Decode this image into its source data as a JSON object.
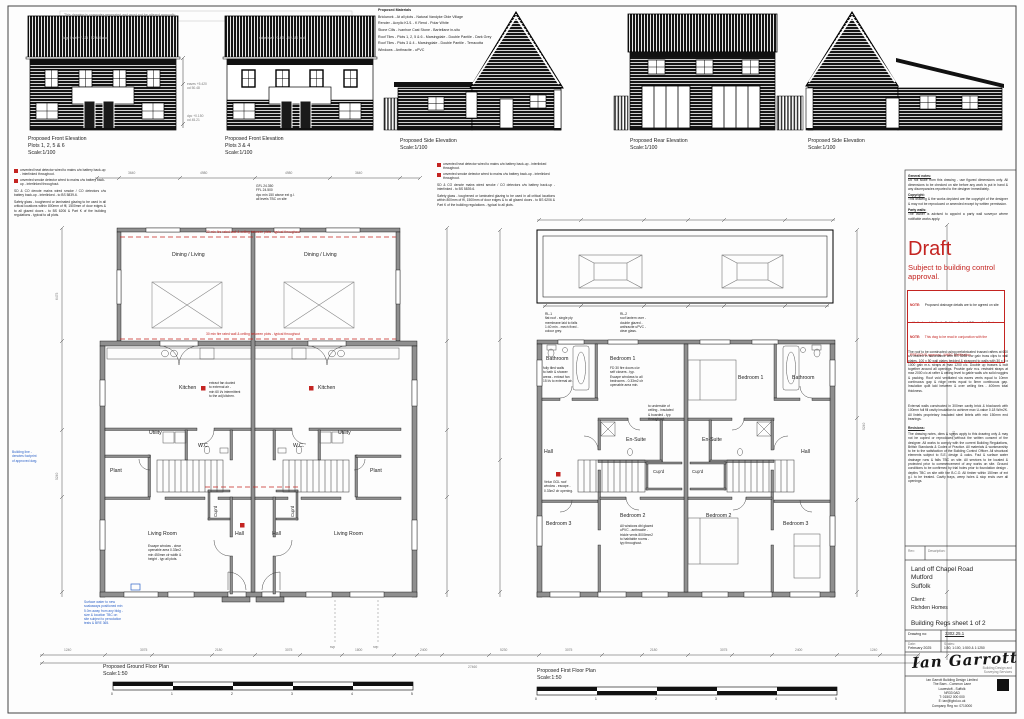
{
  "page": {
    "top_note": "This drawing is computer generated and must not be altered manually"
  },
  "materials": {
    "title": "Proposed Materials",
    "items": [
      "Brickwork - At all plots - Natural Vandyke Olde Village",
      "Render - Acrylic K1/1 - K Rend - Polar White",
      "Stone Cills - Ivanhoe Cast Stone - Bartellane in-situ",
      "Roof Tiles - Plots 1, 2, 5 & 6 - Marsingdale - Double Pantile - Dark Grey",
      "Roof Tiles - Plots 3 & 4 - Marsingdale - Double Pantile - Terracotta",
      "Windows - Anthracite - uPVC"
    ]
  },
  "elevations": [
    {
      "title": "Proposed Front Elevation",
      "plots": "Plots 1, 2, 5 & 6",
      "scale": "Scale:1/100"
    },
    {
      "title": "Proposed Front Elevation",
      "plots": "Plots 3 & 4",
      "scale": "Scale:1/100"
    },
    {
      "title": "Proposed Side Elevation",
      "plots": "",
      "scale": "Scale:1/100"
    },
    {
      "title": "Proposed Rear Elevation",
      "plots": "",
      "scale": "Scale:1/100"
    },
    {
      "title": "Proposed Side Elevation",
      "plots": "",
      "scale": "Scale:1/100"
    }
  ],
  "elev_annots": {
    "ridge1": "ridge level +7.425 - 52.480 aod",
    "ridge2": "ridge level +7.425 - 52.480 aod",
    "eaves": "eaves +5.420\nod 50.48",
    "dpc": "dpc +0.150\nod 45.21"
  },
  "legend": {
    "item_heat": "unvented heat detector wired to mains c/w battery back-up - interlinked throughout.",
    "item_smoke": "unvented smoke detector wired to mains c/w battery back-up - interlinked throughout.",
    "note_sd": "SD & CO denote mains wired smoke / CO detectors c/w battery back-up - interlinked - to BS 5839-6.",
    "note_glass": "Safety glass - toughened or laminated glazing to be used in all critical locations within 800mm of ffl, 1500mm of door edges & to all glazed doors - to BS 6206 & Part K of the building regulations - typical to all plots."
  },
  "ground": {
    "title": "Proposed Ground Floor Plan",
    "scale": "Scale:1:50",
    "rooms": {
      "dining": "Dining / Living",
      "kitchen": "Kitchen",
      "utility": "Utility",
      "wc": "W.C.",
      "plant": "Plant",
      "hall": "Hall",
      "cupd": "Cup'd",
      "living": "Living Room"
    },
    "notes": {
      "levels": "GFL 24.350\nFFL 24.500\ndpc min 150 above ext g.l.\nall levels TBC on site",
      "fire1": "30 min fire rated wall & ceiling between plots - typical throughout",
      "fire2": "30 min fire rated wall & ceiling between plots - typical throughout",
      "kitchen": "extract fan ducted\nto external air -\nmin 60 l/s intermittent\nto the adj kitchen.",
      "living": "Escape window - clear\nopenable area 0.33m2 -\nmin 450mm clr width &\nheight - typ all plots.",
      "svp": "svp",
      "rwp": "rwp",
      "blue_main": "Surface water to new\nsoakaways positioned min\n5.0m away from any bldg -\nsize & location TBC on\nsite subject to percolation\ntests & BRE 365.",
      "blue_side": "Building line -\ndenotes footprint\nof approved dwg."
    }
  },
  "first": {
    "title": "Proposed First Floor Plan",
    "scale": "Scale:1:50",
    "rooms": {
      "bathroom": "Bathroom",
      "bedroom1": "Bedroom 1",
      "ensuite": "En-Suite",
      "hall": "Hall",
      "cupd": "Cup'd",
      "bedroom2": "Bedroom 2",
      "bedroom3": "Bedroom 3"
    },
    "notes": {
      "roof1": "RL-1\nflat roof - single ply\nmembrane laid to falls\n1:40 min - mech fixed -\ncolour grey.",
      "roof2": "RL-2\nroof lantern over -\ndouble glazed -\nanthracite uPVC -\nclear glass.",
      "bath": "fully tiled walls\nto bath & shower\nareas - extract fan\n15 l/s to external air.",
      "bed1": "FD 30 fire doors c/w\nself closers - typ.\nEscape windows to all\nbedrooms - 0.33m2 clr\nopenable area min.",
      "bed1r": "to underside of\nceiling - insulated\n& boarded - typ\nthroughout.",
      "bed2": "All windows dbl glazed\nuPVC - anthracite -\ntrickle vents 8000mm2\nto habitable rooms -\ntyp throughout.",
      "escape": "Velux GGL roof\nwindow - escape -\n0.33m2 clr opening."
    }
  },
  "scalebar": {
    "n0": "0",
    "n1": "1",
    "n2": "2",
    "n3": "3",
    "n4": "4",
    "n5": "5"
  },
  "dims": {
    "t1": "3640",
    "t2": "4980",
    "t3": "4980",
    "t4": "3640",
    "b1": "1240",
    "b2": "3075",
    "b3": "2180",
    "b4": "3075",
    "b5": "1800",
    "b6": "2400",
    "b7": "5230",
    "b8": "3075",
    "b9": "2180",
    "b10": "3075",
    "b11": "2400",
    "b12": "1240",
    "overall": "27460",
    "v1": "6475",
    "v2": "5240",
    "v3": "9240",
    "v4": "12240"
  },
  "right": {
    "h1": "General notes:",
    "p1": "Do not scale from this drawing - use figured dimensions only. All dimensions to be checked on site before any work is put in hand & any discrepancies reported to the designer immediately.",
    "h2": "Copyright:",
    "p2": "This drawing & the works depicted are the copyright of the designer & may not be reproduced or amended except by written permission.",
    "h3": "Party walls:",
    "p3b": "The owner is advised to appoint a party wall surveyor where notifiable works apply.",
    "draft": "Draft",
    "draft_sub": "Subject to building control approval.",
    "note_label1": "NOTE:",
    "note1": "Proposed drainage details are to be agreed on site with the Local Authority Building Control Officer - foul & storm to be confirmed on site.",
    "note_label2": "NOTE:",
    "note2": "This dwg to be read in conjunction with the PREVIOUS approval - NHBC certification.",
    "p4": "The roof to be constructed using prefabricated trussed rafters at 600 c/c braced in accordance with BS 5268 c/w galv truss clips to wall plates. 100 x 50 wall plates bedded & strapped to walls with 30 x 5 x 1000 galv m.s. straps at max 1200 c/c. Double up trusses & bolt together around all openings. Provide galv m.s. restraint straps at max 2000 c/c at rafter & ceiling level to gable walls c/w solid noggins & packing. Roof void ventilated via eaves vents equal to 10mm continuous gap & ridge vents equal to 5mm continuous gap. Insulation quilt laid between & over ceiling ties - 400mm total thickness.",
    "p5": "External walls constructed in 300mm cavity brick & blockwork with 100mm full fill cavity insulation to achieve max U-value 0.18 W/m2K. All lintels proprietary insulated steel lintels with min 150mm end bearings.",
    "rev_h": "Revisions:",
    "p6": "The drawing notes, dims & specs apply to this drawing only & may not be copied or reproduced without the written consent of the designer. All works to comply with the current Building Regulations, British Standards & Codes of Practice. All materials & workmanship to be to the satisfaction of the Building Control Officer. All structural elements subject to S.E. design & calcs. Foul & surface water drainage runs & falls TBC on site. All services to be located & protected prior to commencement of any works on site. Ground conditions to be confirmed by trial holes prior to foundation design - depths TBC on site with the B.C.O. All timber within 150mm of ext g.l. to be treated. Cavity trays, weep holes & stop ends over all openings.",
    "rev_cell1": "Rev:",
    "rev_cell2": "Description:",
    "address": "Land off Chapel Road\nMutford\nSuffolk",
    "client_label": "Client:",
    "client": "Richden Homes",
    "sheet_title": "Building Regs sheet 1 of 2",
    "drawing_no_label": "Drawing no:",
    "drawing_no": "3302.25.1",
    "date_label": "Date:",
    "date": "February 2025",
    "scales_label": "Scales:",
    "scales": "1:50, 1:100, 1:500 & 1:1250",
    "signature": "Ian Garrott",
    "sig_tag": "Building Design and\nSurveying Services",
    "company": "Ian Garrott Building Design Limited\nThe Barn - Common Lane\nLowestoft - Suffolk\nNR33 0AD\nT: 01502 000 000\nE: ian@igbd.co.uk\nCompany Reg no: 0710000"
  }
}
